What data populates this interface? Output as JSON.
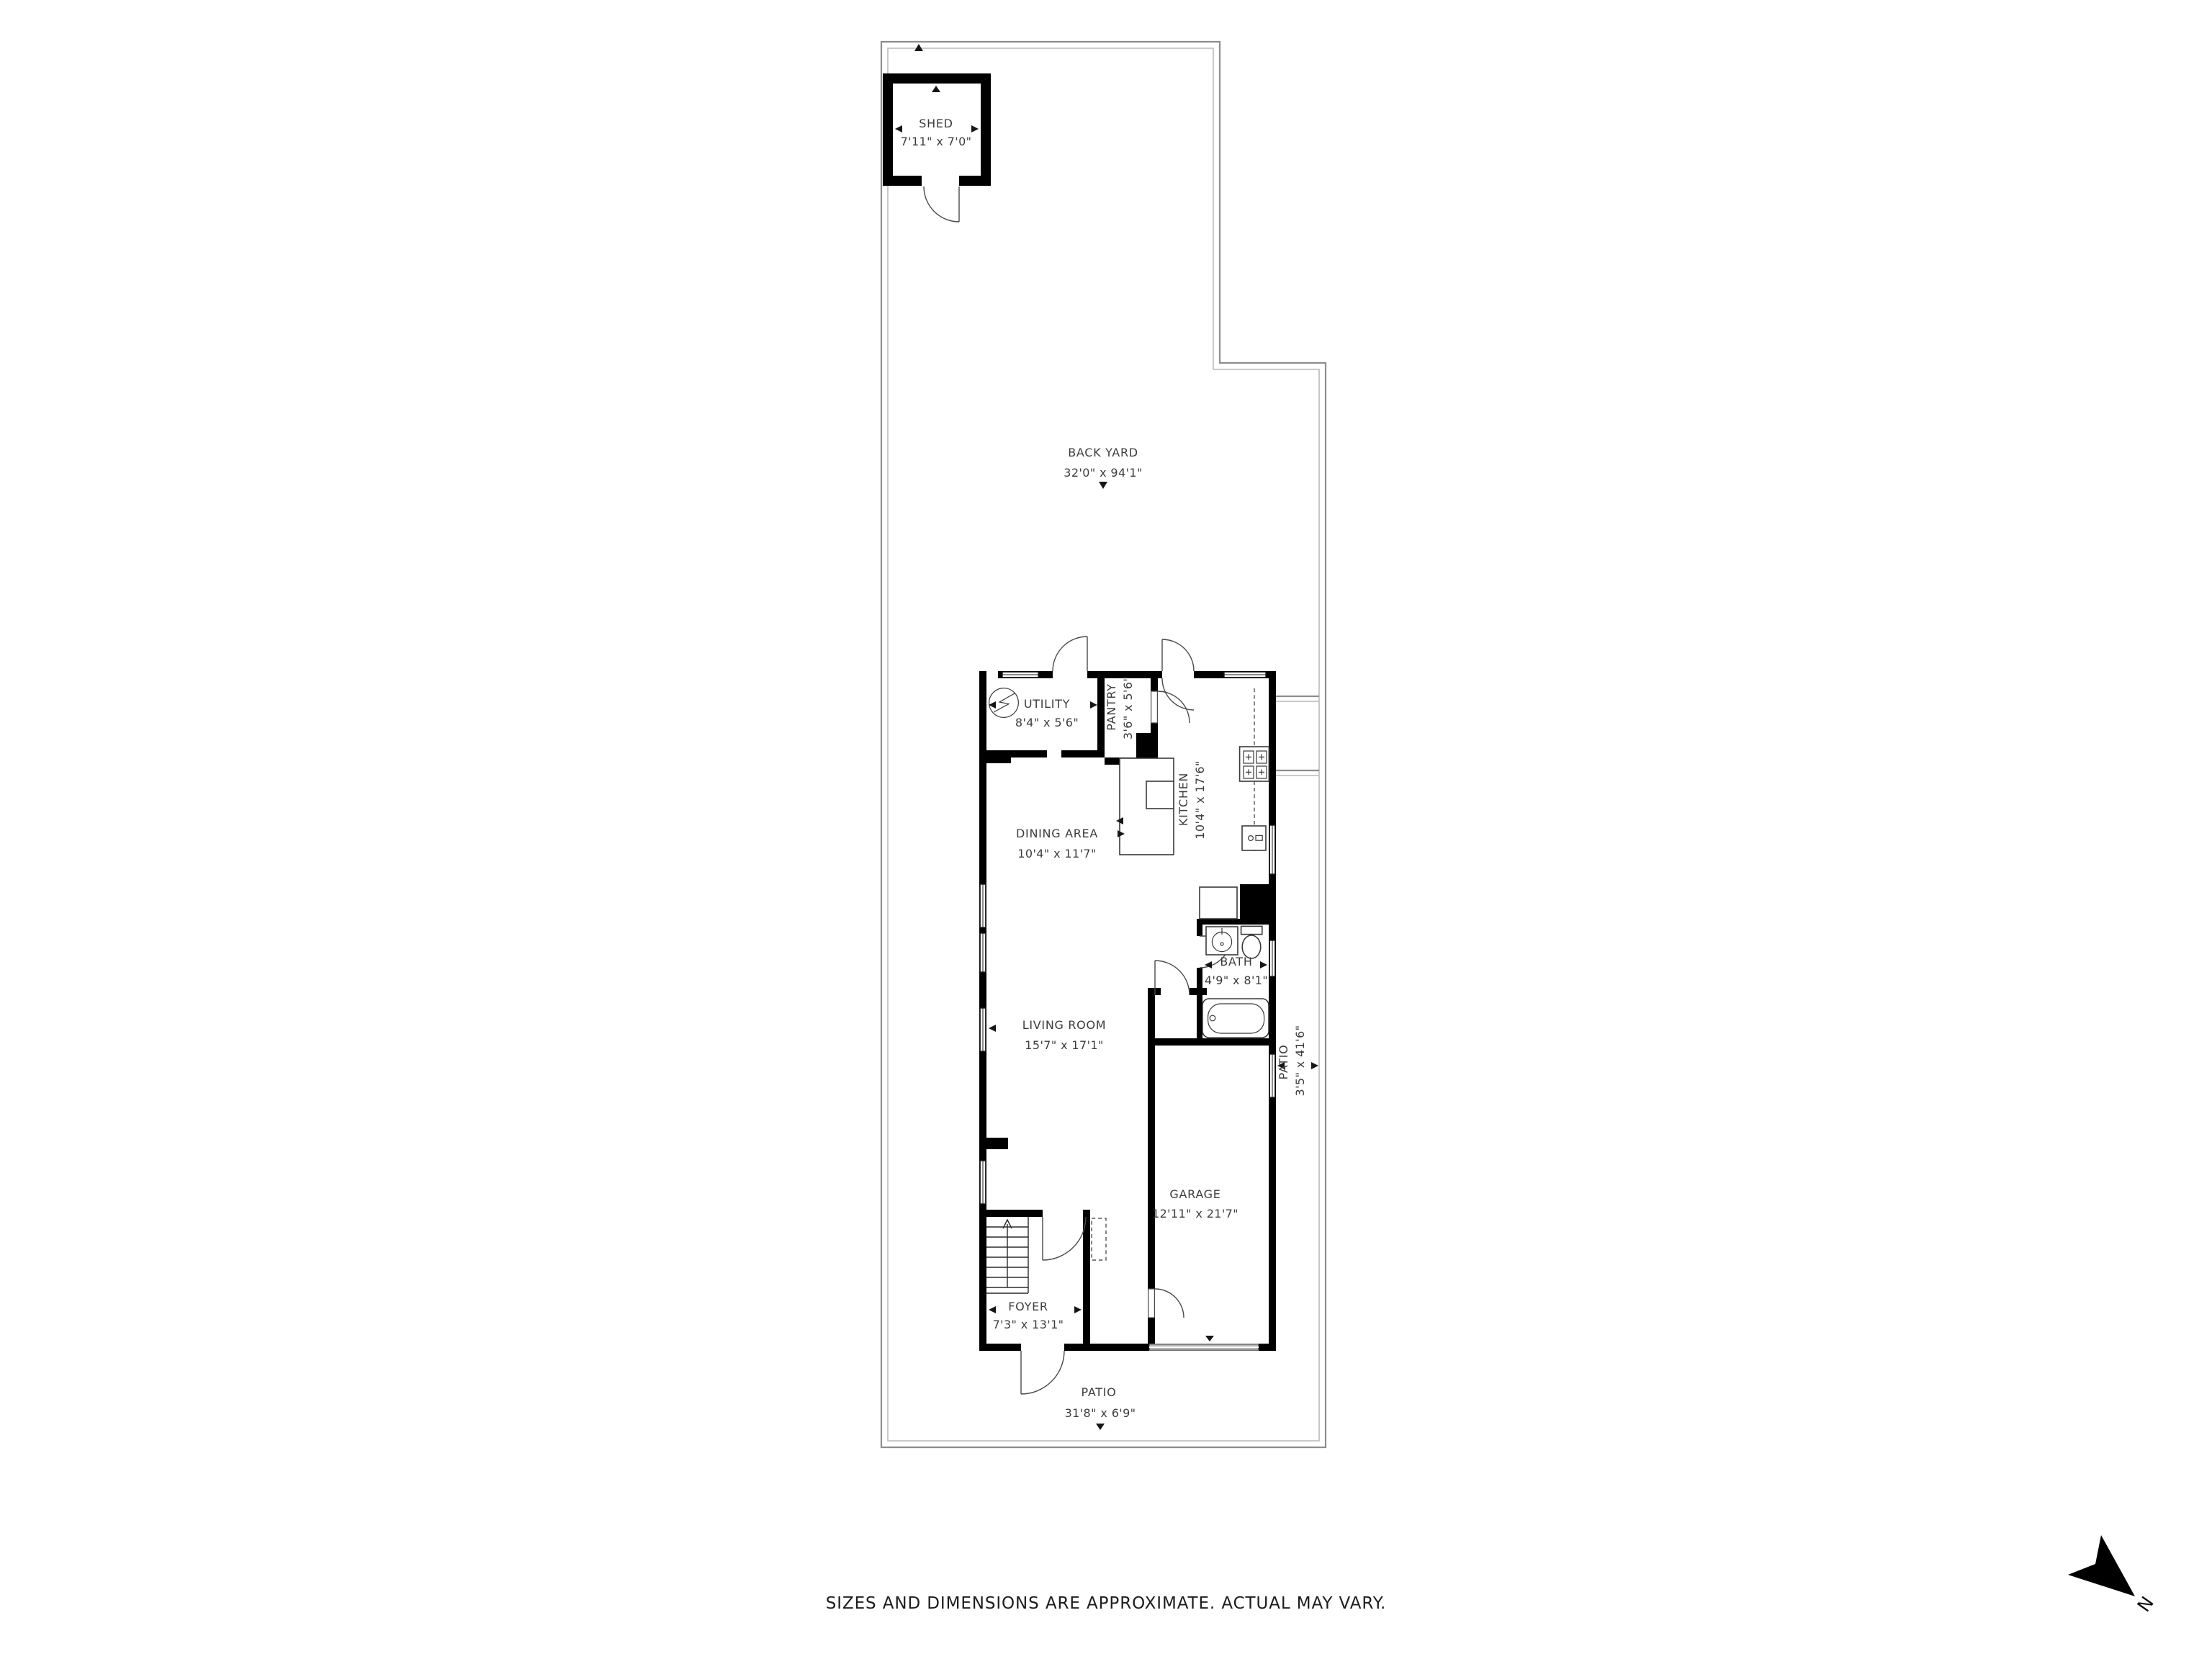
{
  "rooms": [
    {
      "id": "shed",
      "name": "SHED",
      "dims": "7'11\" x 7'0\""
    },
    {
      "id": "back-yard",
      "name": "BACK YARD",
      "dims": "32'0\" x 94'1\""
    },
    {
      "id": "utility",
      "name": "UTILITY",
      "dims": "8'4\" x 5'6\""
    },
    {
      "id": "pantry",
      "name": "PANTRY",
      "dims": "3'6\" x 5'6\""
    },
    {
      "id": "kitchen",
      "name": "KITCHEN",
      "dims": "10'4\" x 17'6\""
    },
    {
      "id": "dining-area",
      "name": "DINING AREA",
      "dims": "10'4\" x 11'7\""
    },
    {
      "id": "bath",
      "name": "BATH",
      "dims": "4'9\" x 8'1\""
    },
    {
      "id": "living-room",
      "name": "LIVING ROOM",
      "dims": "15'7\" x 17'1\""
    },
    {
      "id": "patio-side",
      "name": "PATIO",
      "dims": "3'5\" x 41'6\""
    },
    {
      "id": "garage",
      "name": "GARAGE",
      "dims": "12'11\" x 21'7\""
    },
    {
      "id": "foyer",
      "name": "FOYER",
      "dims": "7'3\" x 13'1\""
    },
    {
      "id": "patio-front",
      "name": "PATIO",
      "dims": "31'8\" x 6'9\""
    }
  ],
  "footer": {
    "disclaimer": "SIZES AND DIMENSIONS ARE APPROXIMATE. ACTUAL MAY VARY."
  },
  "compass": {
    "north_label": "N"
  },
  "colors": {
    "wall": "#000000",
    "boundary": "#8d8d8d",
    "text": "#3d3d3d",
    "garage_door": "#b3b3b3"
  }
}
